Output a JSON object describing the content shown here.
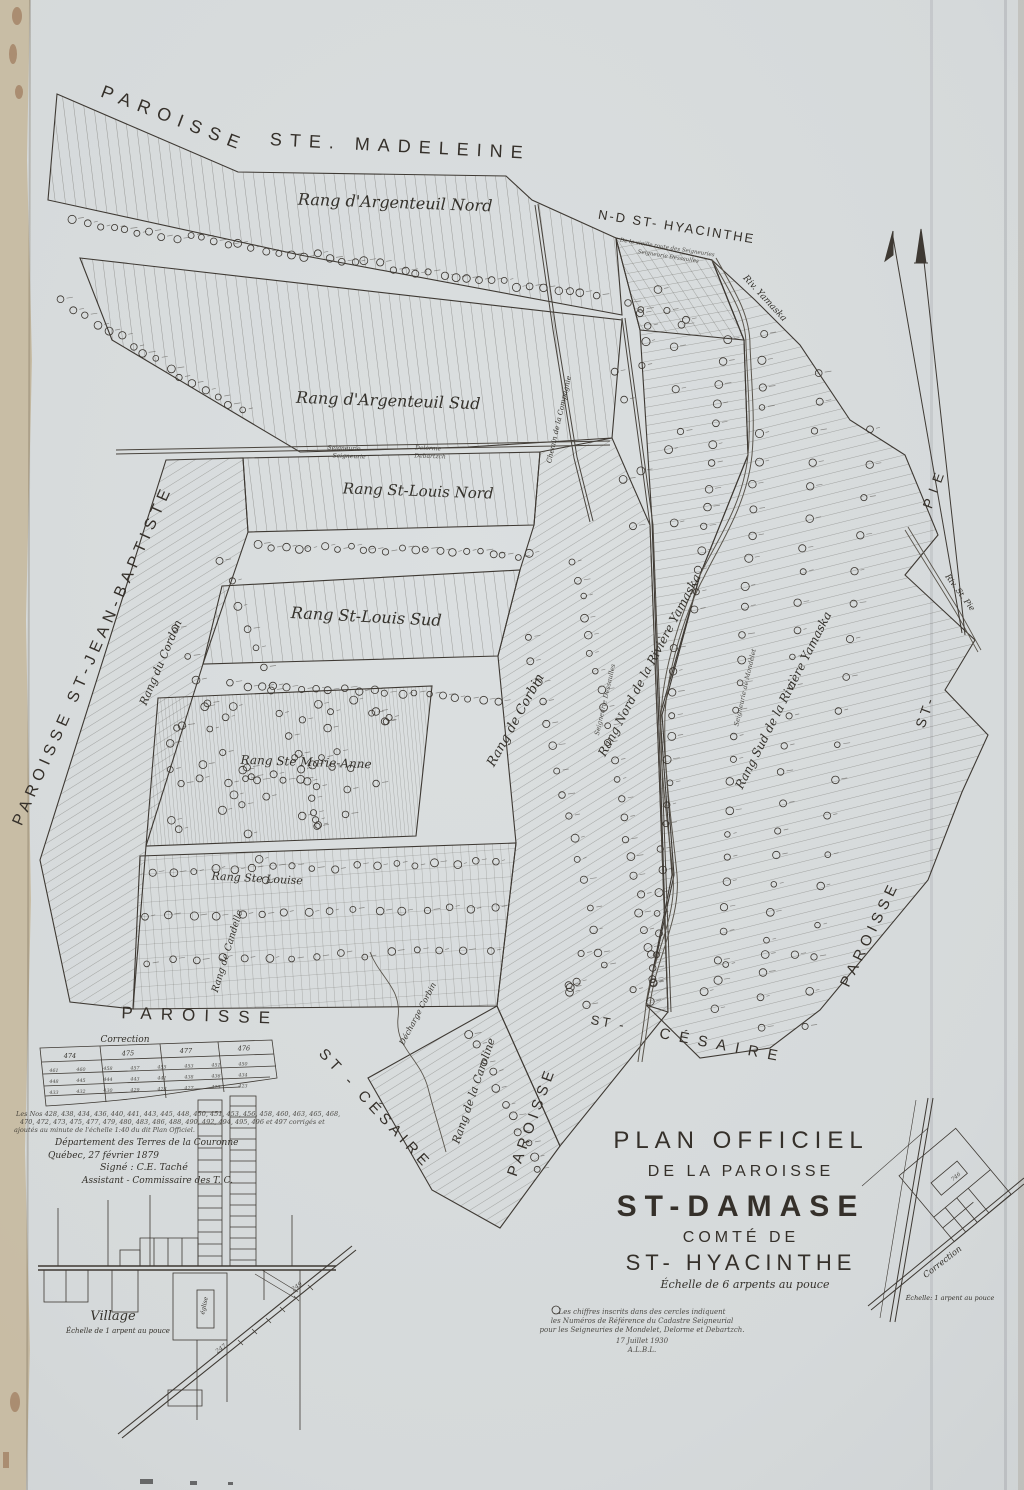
{
  "colors": {
    "paper": "#d6dadb",
    "ink": "#35302a",
    "edge_strip": "#c6b99f",
    "stain": "#8d5f3f"
  },
  "labels": {
    "boundary": [
      {
        "text": "PAROISSE"
      },
      {
        "text": "STE.  MADELEINE"
      },
      {
        "text": "N-D  ST- HYACINTHE"
      },
      {
        "text": "PAROISSE ST-JEAN-BAPTISTE"
      },
      {
        "text": "PIE"
      },
      {
        "text": "ST-"
      },
      {
        "text": "PAROISSE"
      },
      {
        "text": "PAROISSE"
      },
      {
        "text": "ST - CÉSAIRE"
      },
      {
        "text": "PAROISSE"
      },
      {
        "text": "ST -"
      },
      {
        "text": "CÉSAIRE"
      }
    ],
    "rang": [
      {
        "text": "Rang d'Argenteuil Nord"
      },
      {
        "text": "Rang d'Argenteuil Sud"
      },
      {
        "text": "Rang St-Louis Nord"
      },
      {
        "text": "Rang St-Louis Sud"
      },
      {
        "text": "Rang Ste Marie-Anne"
      },
      {
        "text": "Rang Ste Louise"
      },
      {
        "text": "Rang de Candelle"
      },
      {
        "text": "Rang du Cordon"
      },
      {
        "text": "Rang de Corbin"
      },
      {
        "text": "Rang Nord de la Rivière Yamaska"
      },
      {
        "text": "Rang Sud de la Rivière Yamaska"
      },
      {
        "text": "Rang de la Caroline"
      },
      {
        "text": "Décharge Corbin"
      },
      {
        "text": "Chemin de la Compagnie"
      }
    ],
    "water": [
      {
        "text": "Riv. Yamaska"
      },
      {
        "text": "Riv. St. Pie"
      }
    ],
    "seigneurie": [
      {
        "text": "Seigneurie"
      },
      {
        "text": "Seigneurie"
      },
      {
        "text": "Delorme"
      },
      {
        "text": "Debartzch"
      },
      {
        "text": "Seigneurie Dessaulles"
      },
      {
        "text": "Seigneurie de Mondelet"
      },
      {
        "text": "De la vieille route des Seigneuries"
      },
      {
        "text": "Seigneurie Dessaulles"
      }
    ]
  },
  "title_block": {
    "line1": "PLAN OFFICIEL",
    "line2": "DE LA PAROISSE",
    "line3": "ST-DAMASE",
    "line4": "COMTÉ DE",
    "line5": "ST- HYACINTHE",
    "scale": "Échelle de 6 arpents au pouce",
    "notes": [
      "Les chiffres inscrits dans des cercles indiquent",
      "les Numéros de Référence du Cadastre Seigneurial",
      "pour les Seigneuries de Mondelet, Delorme et Debartzch.",
      "17 Juillet 1930",
      "A.L.B.L."
    ]
  },
  "notes_block": {
    "paragraph": [
      "Les Nos 428, 438, 434, 436, 440, 441, 443, 445, 448, 450, 451, 453, 456, 458, 460, 463, 465, 468,",
      "470, 472, 473, 475, 477, 479, 480, 483, 486, 488, 490, 492, 494, 495, 496 et 497 corrigés et",
      "ajoutés au minute de l'échelle 1:40 du dit Plan Officiel."
    ],
    "dept": "Département des Terres de la Couronne",
    "place_date": "Québec, 27 février 1879",
    "signed": "Signé : C.E. Taché",
    "role": "Assistant - Commissaire des T. C."
  },
  "correction": {
    "title": "Correction",
    "header": [
      "474",
      "475",
      "477",
      "476"
    ],
    "cells": [
      "461",
      "460",
      "458",
      "457",
      "455",
      "453",
      "451",
      "450",
      "448",
      "445",
      "444",
      "443",
      "441",
      "438",
      "436",
      "434",
      "433",
      "432",
      "430",
      "429",
      "428",
      "427",
      "425",
      "423"
    ]
  },
  "village": {
    "title": "Village",
    "scale": "Échelle de 1 arpent au pouce",
    "church": "église",
    "numbers": [
      "249",
      "247"
    ]
  },
  "corner": {
    "title": "Correction",
    "scale": "Échelle: 1 arpent au pouce",
    "lot": "746"
  }
}
